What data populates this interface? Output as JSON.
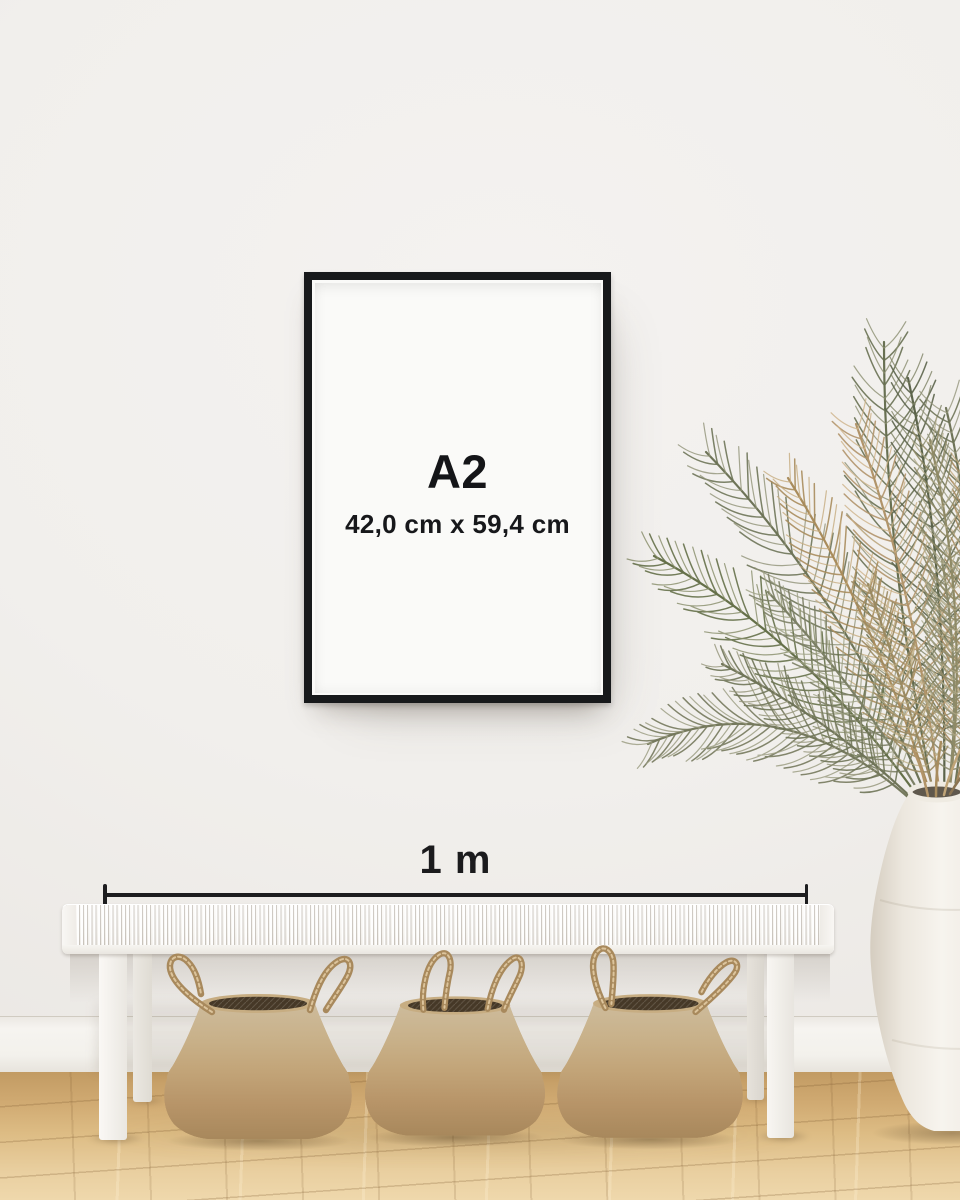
{
  "poster": {
    "size_label": "A2",
    "dimensions": "42,0 cm x 59,4 cm"
  },
  "scale_bar": {
    "label": "1 m"
  },
  "palette": {
    "wall": "#f1efec",
    "baseboard": "#f4f2ed",
    "floor_wood": "#dcb982",
    "frame_black": "#17191b",
    "poster_background": "#e8e5e2",
    "text_black": "#17181a",
    "bench_white": "#f4f2ee",
    "basket_seagrass": "#c2a478",
    "vase_white": "#f3efe8",
    "plant_green": "#6b7156",
    "plant_brown": "#ab8e60"
  }
}
